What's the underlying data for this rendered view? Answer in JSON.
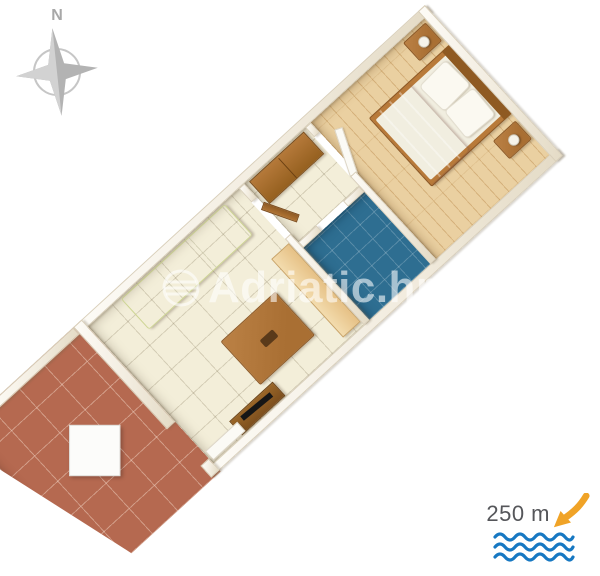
{
  "compass": {
    "label": "N",
    "icon": "compass-rose-icon"
  },
  "watermark": {
    "text": "Adriatic.hr",
    "logo_icon": "adriatic-globe-logo-icon"
  },
  "distance": {
    "label": "250 m",
    "arrow_icon": "direction-to-sea-arrow-icon",
    "sea_icon": "sea-waves-icon"
  },
  "colors": {
    "wall-fill": "#f2ecdf",
    "tile-cream": "#f3eed9",
    "terracotta": "#b56950",
    "bath-blue": "#2e6e91",
    "parquet": "#ead0a1",
    "wood": "#a96f33",
    "sofa": "#e9eebc",
    "blanket": "#f7cfc2",
    "compass-gray": "#b3b3b3",
    "text-gray": "#55565a",
    "arrow-orange": "#f0a327",
    "wave-blue": "#1778c2"
  }
}
